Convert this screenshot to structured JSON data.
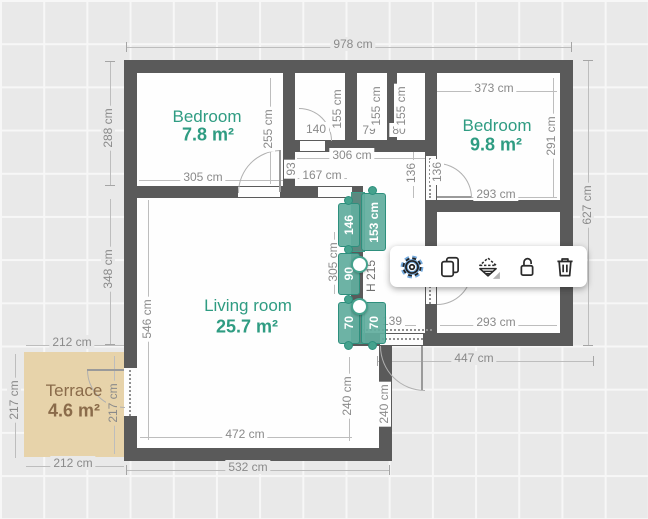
{
  "app": {
    "view": "floor-plan-editor"
  },
  "colors": {
    "wall": "#5a5a5a",
    "selection_teal": "#45a28d",
    "room_label_teal": "#2f9c82",
    "terrace_fill": "#e7d3aa",
    "terrace_text": "#8a6b4a",
    "dimension_text": "#8a8a8a",
    "gear_highlight": "#74a9dc"
  },
  "rooms": {
    "bedroom1": {
      "name": "Bedroom",
      "area": "7.8 m²"
    },
    "bedroom2": {
      "name": "Bedroom",
      "area": "9.8 m²"
    },
    "living": {
      "name": "Living room",
      "area": "25.7 m²"
    },
    "terrace": {
      "name": "Terrace",
      "area": "4.6 m²"
    }
  },
  "dims": {
    "total_width": "978 cm",
    "bed2_top": "373 cm",
    "bed1_left": "288 cm",
    "bed1_right": "255 cm",
    "closet1_w": "140",
    "closet1_h": "155 cm",
    "closet2_w": "79",
    "closet2_h": "155 cm",
    "closet3_w": "80",
    "closet3_h": "155 cm",
    "hall_top": "306 cm",
    "hall_corridor": "167 cm",
    "corridor_h": "93",
    "bed1_bottom": "305 cm",
    "bed2_right": "291 cm",
    "bed2_bottom": "293 cm",
    "right_total": "627 cm",
    "hall_door1": "136",
    "hall_door2": "136",
    "room3_bottom": "293 cm",
    "bottom_right": "447 cm",
    "entry": "139",
    "wall_sel": "305 cm",
    "living_right1": "240 cm",
    "living_right2": "240 cm",
    "living_bottom": "472 cm",
    "bottom_left": "532 cm",
    "living_left": "546 cm",
    "left_mid": "348 cm",
    "terrace_top": "212 cm",
    "terrace_left": "217 cm",
    "terrace_right": "217 cm",
    "terrace_bottom": "212 cm"
  },
  "selection": {
    "seg_top": "146",
    "window_main": "153 cm",
    "seg_mid": "90",
    "seg_bottom": "70",
    "window_small": "70",
    "height": "H 215"
  },
  "toolbar": {
    "icons": [
      {
        "name": "settings-icon"
      },
      {
        "name": "duplicate-icon"
      },
      {
        "name": "flip-icon"
      },
      {
        "name": "unlock-icon"
      },
      {
        "name": "delete-icon"
      }
    ]
  }
}
